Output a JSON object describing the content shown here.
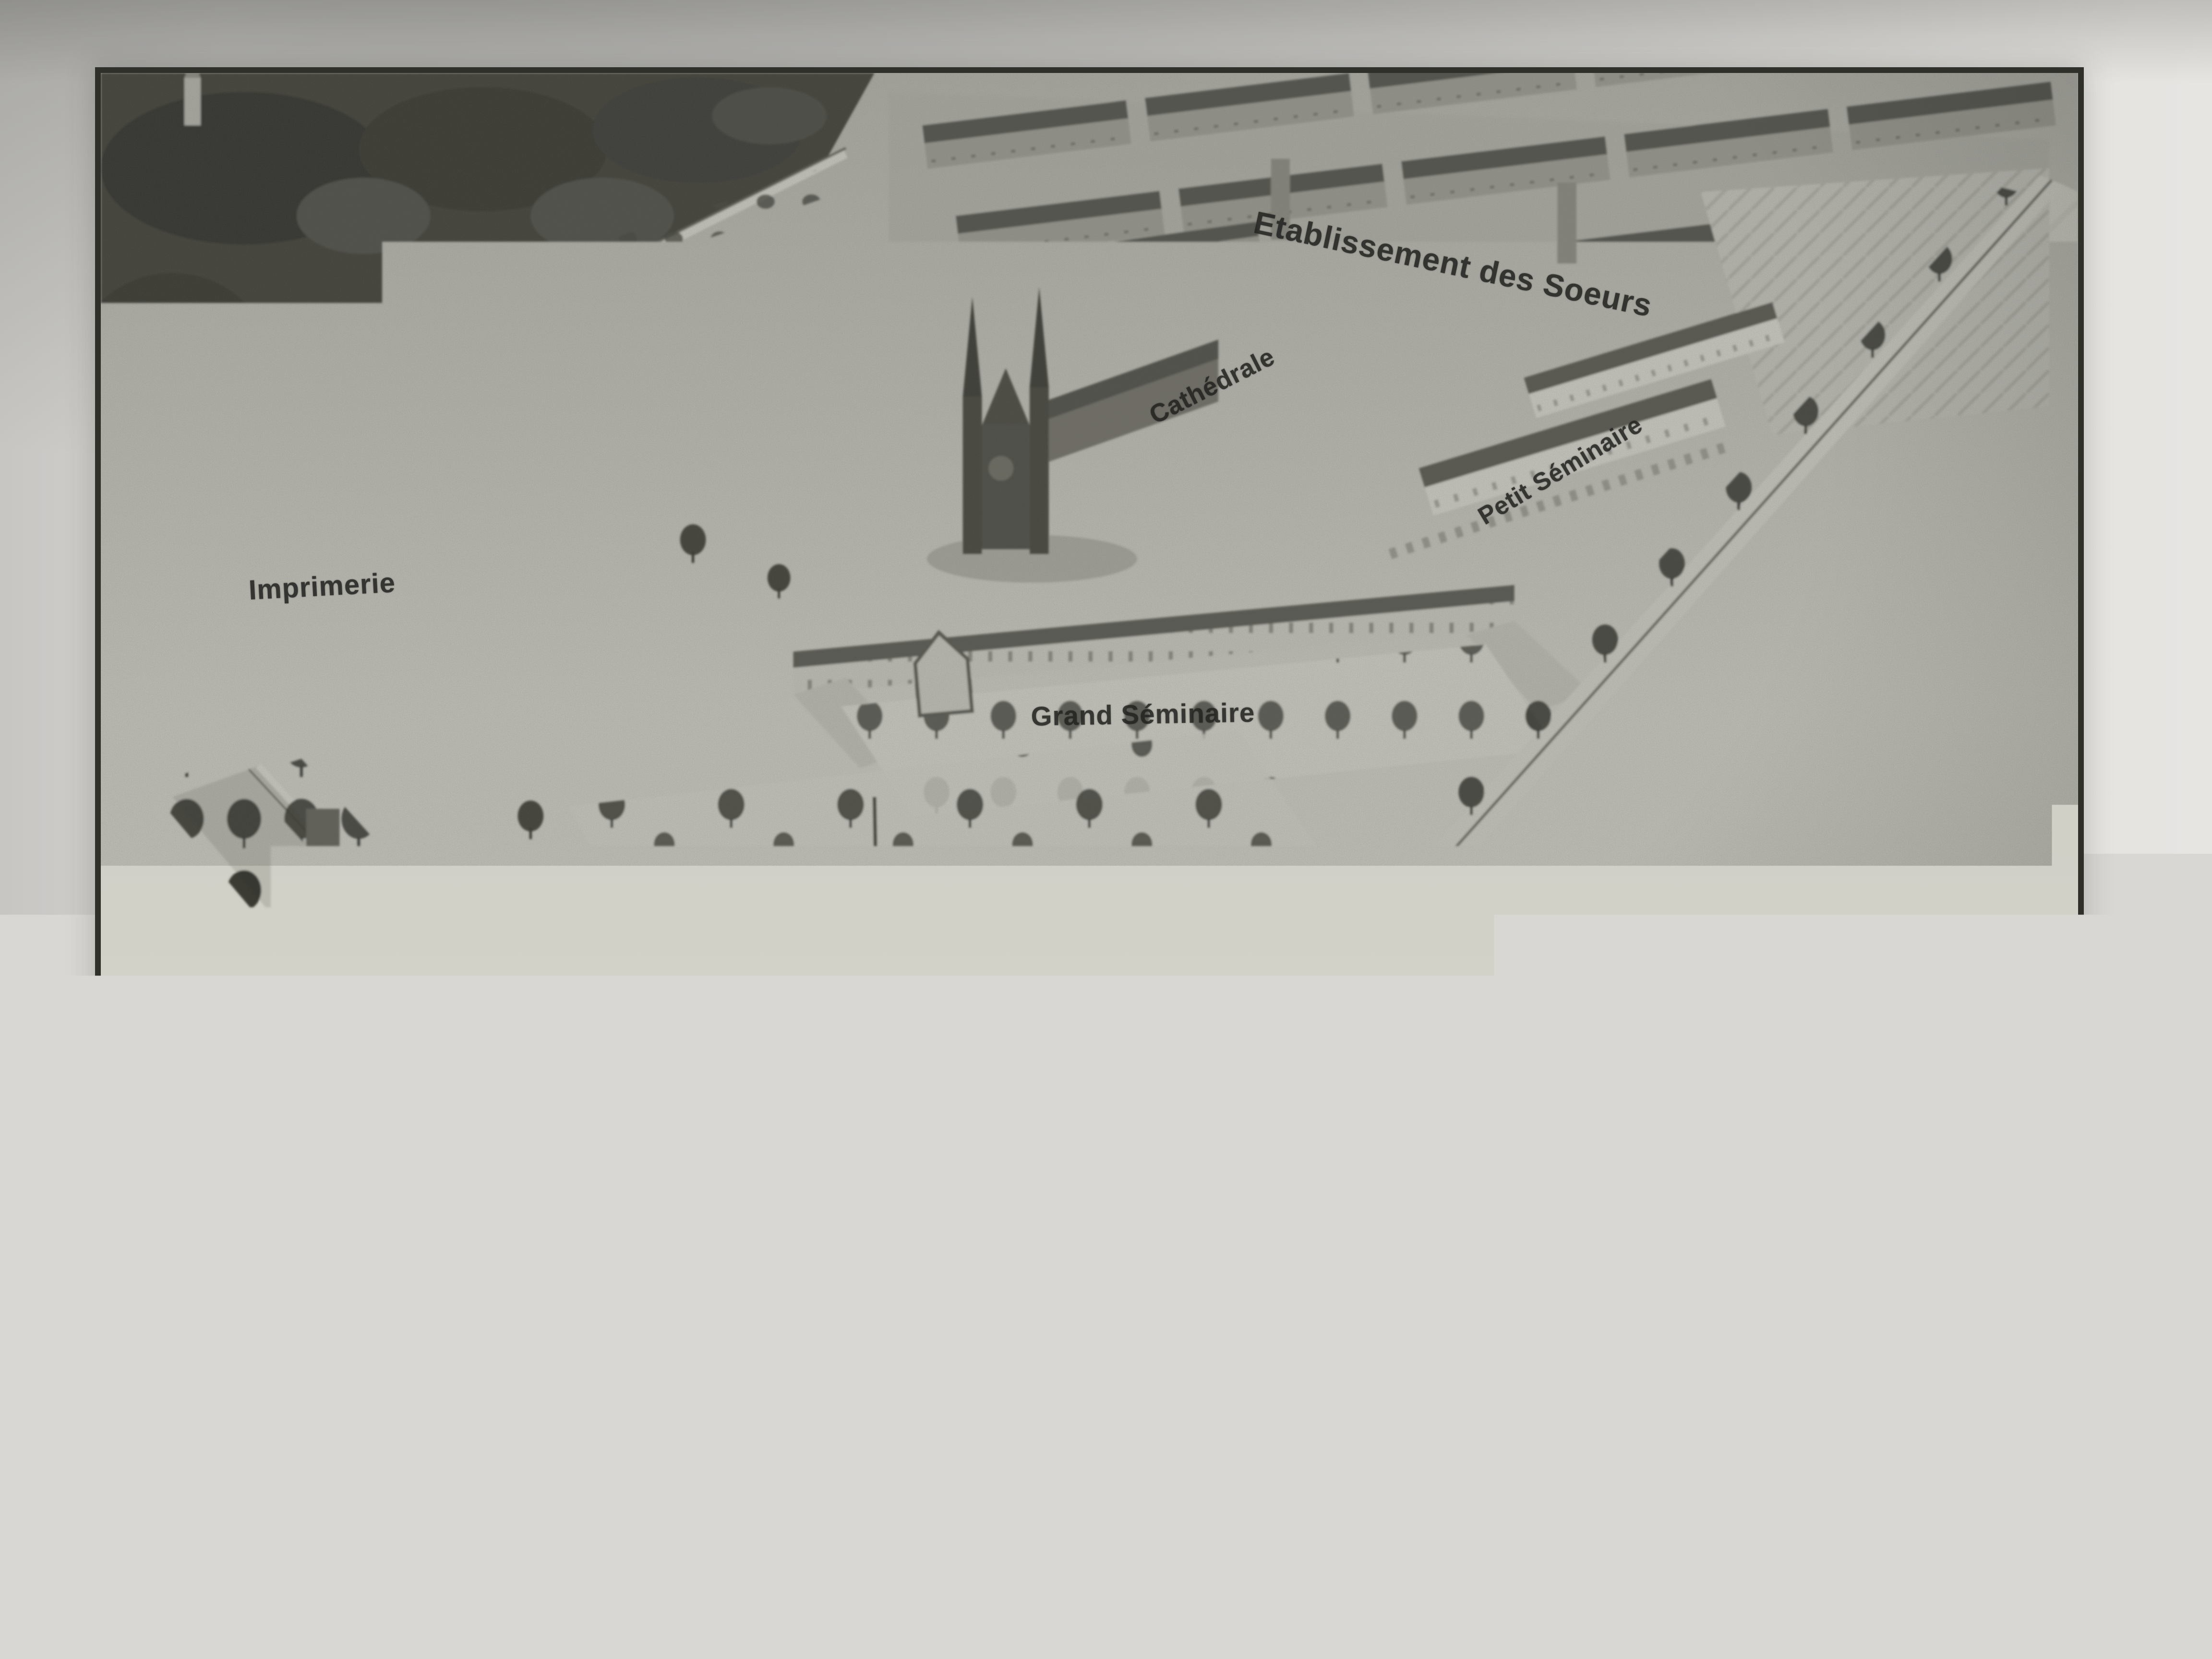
{
  "illustration": {
    "caption": "LE PÉTANG A VOL D'OISEAU.",
    "labels": [
      {
        "name": "etablissement-des-soeurs",
        "text": "Etablissement des Soeurs"
      },
      {
        "name": "cathedrale",
        "text": "Cathédrale"
      },
      {
        "name": "petit-seminaire",
        "text": "Petit Séminaire"
      },
      {
        "name": "imprimerie",
        "text": "Imprimerie"
      },
      {
        "name": "grand-seminaire",
        "text": "Grand Séminaire"
      },
      {
        "name": "ecole-primaire",
        "text": "École primaire"
      },
      {
        "name": "maison-mere-des-josephines",
        "lines": [
          "Maison-mère",
          "des Joséphines"
        ]
      },
      {
        "name": "maisons-des-chretiens",
        "lines": [
          "Maisons des",
          "Chrétiens"
        ]
      }
    ]
  }
}
